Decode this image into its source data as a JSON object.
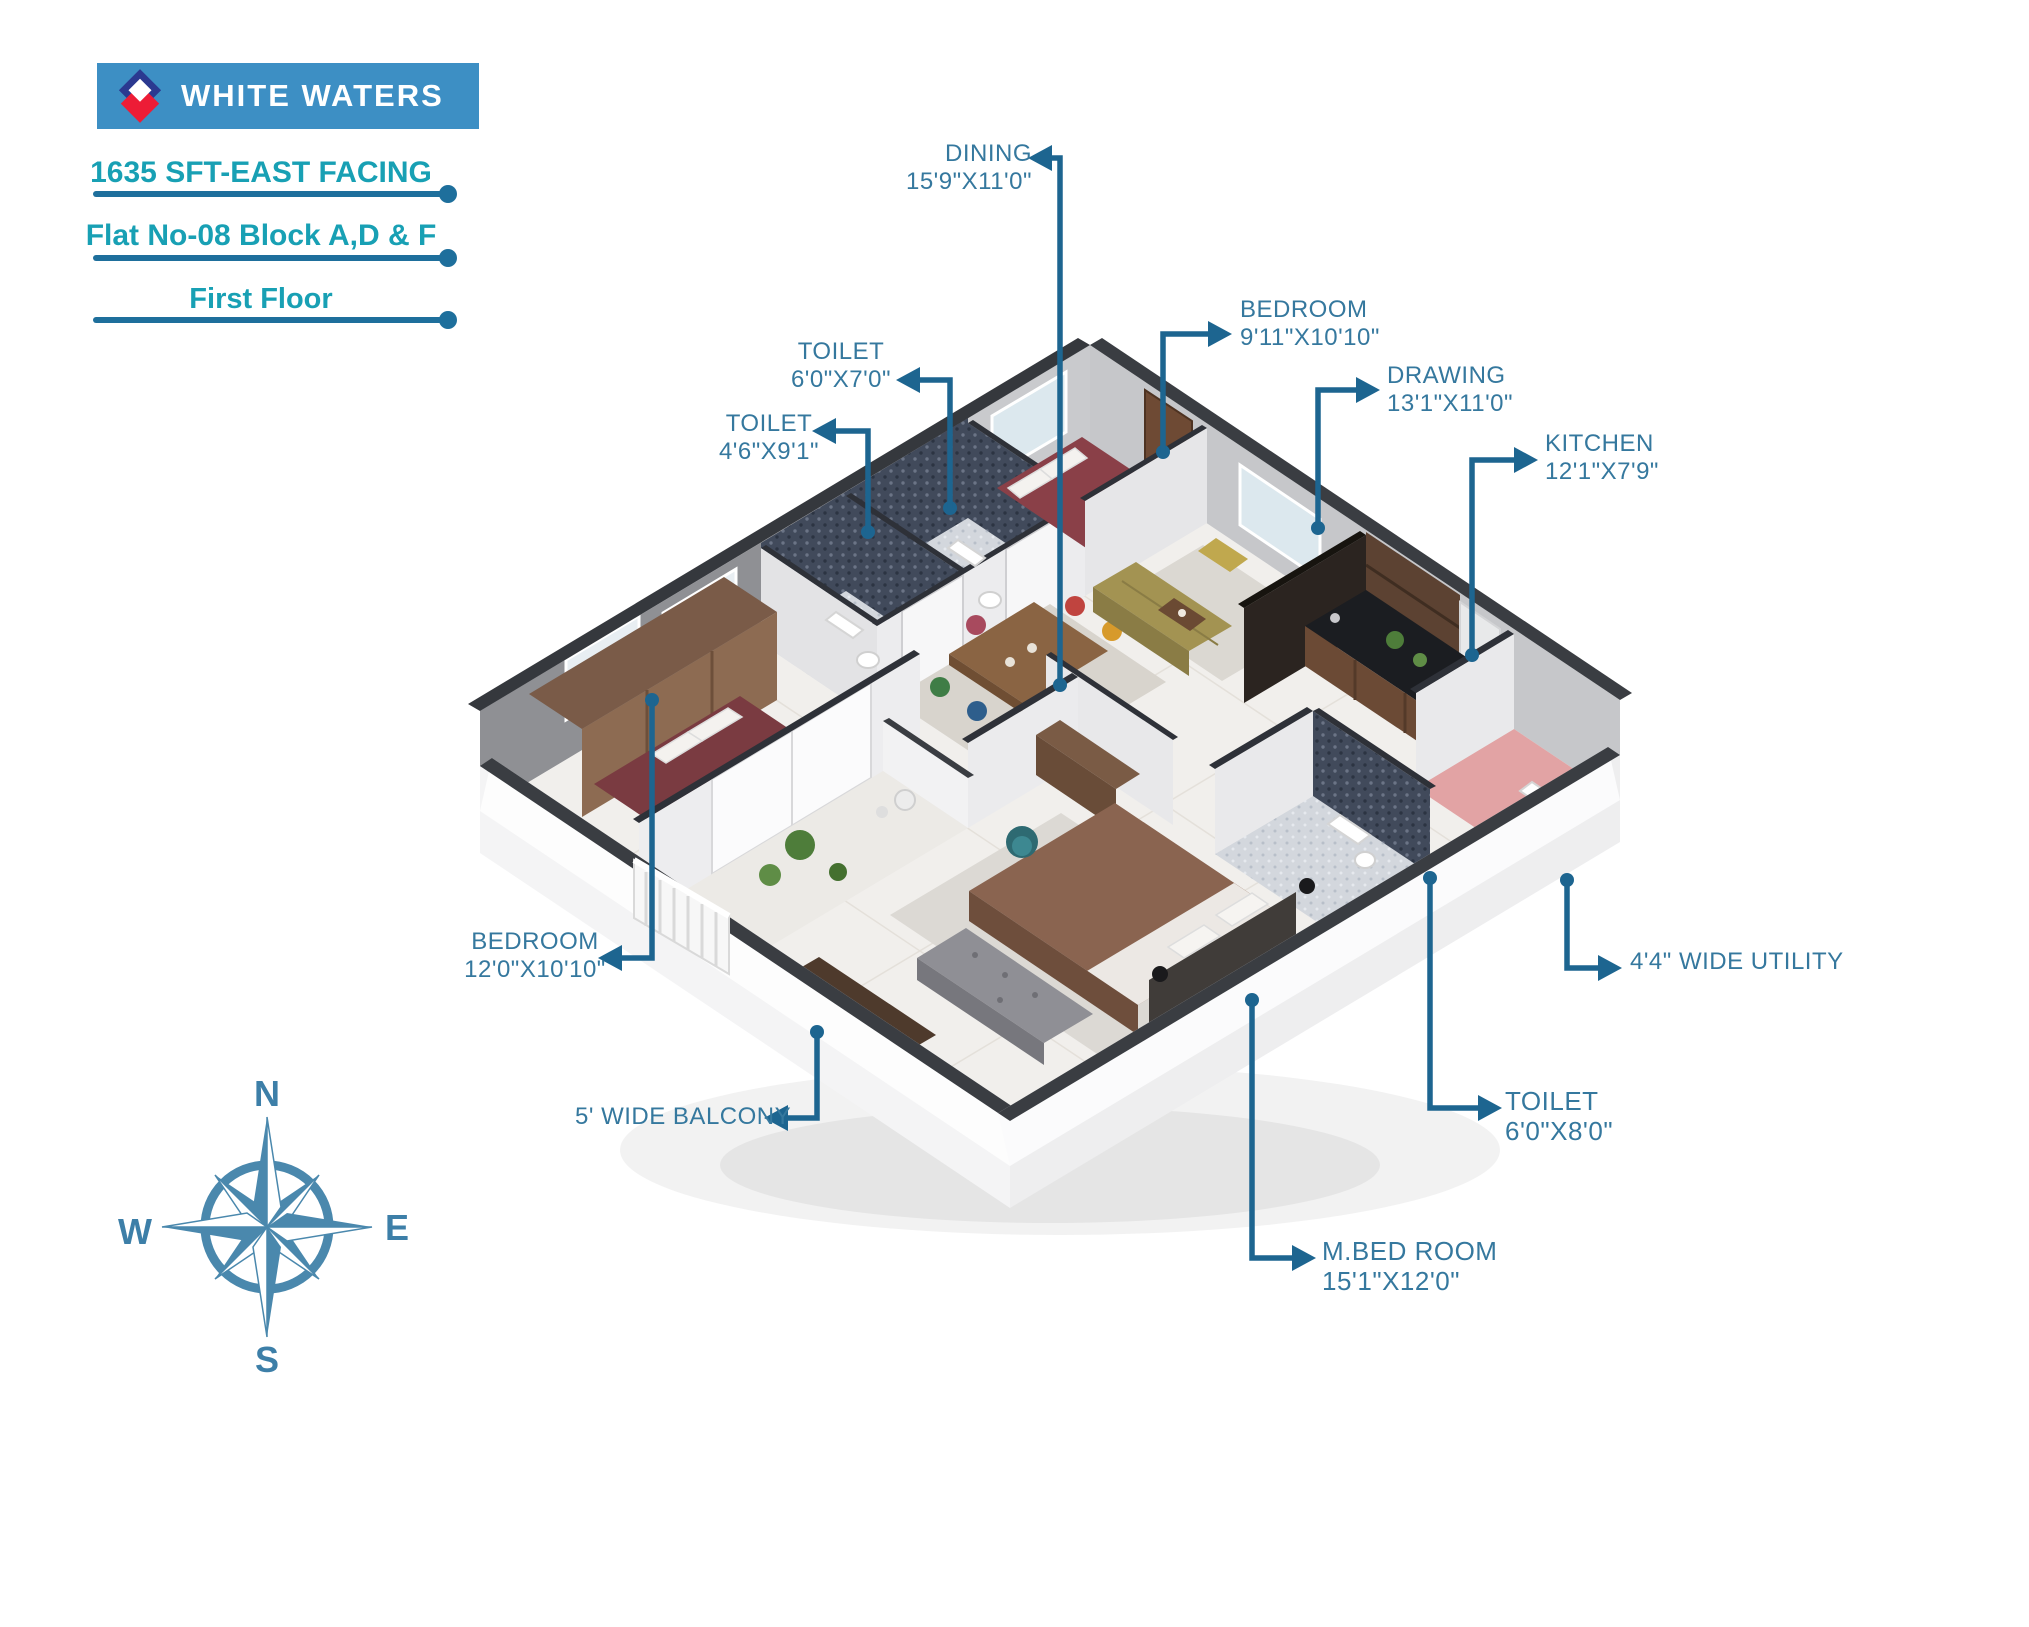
{
  "brand": {
    "title": "WHITE WATERS"
  },
  "header": {
    "line1": "1635 SFT-EAST FACING",
    "line2": "Flat No-08 Block A,D & F",
    "line3": "First Floor"
  },
  "labels": {
    "dining": {
      "name": "DINING",
      "dims": "15'9\"X11'0\""
    },
    "bedroom_top": {
      "name": "BEDROOM",
      "dims": "9'11\"X10'10\""
    },
    "drawing": {
      "name": "DRAWING",
      "dims": "13'1\"X11'0\""
    },
    "kitchen": {
      "name": "KITCHEN",
      "dims": "12'1\"X7'9\""
    },
    "toilet_1": {
      "name": "TOILET",
      "dims": "6'0\"X7'0\""
    },
    "toilet_2": {
      "name": "TOILET",
      "dims": "4'6\"X9'1\""
    },
    "bedroom_left": {
      "name": "BEDROOM",
      "dims": "12'0\"X10'10\""
    },
    "balcony": {
      "name": "5' WIDE BALCONY"
    },
    "utility": {
      "name": "4'4\" WIDE UTILITY"
    },
    "toilet_3": {
      "name": "TOILET",
      "dims": "6'0\"X8'0\""
    },
    "mbed": {
      "name": "M.BED ROOM",
      "dims": "15'1\"X12'0\""
    }
  },
  "compass": {
    "north": "N",
    "east": "E",
    "south": "S",
    "west": "W"
  },
  "colors": {
    "banner_blue": "#3D8FC4",
    "accent_teal": "#18A0B4",
    "rule_blue": "#1E6F9C",
    "label_blue": "#35789E",
    "leader_blue": "#1D6590",
    "logo_navy": "#2B3990",
    "logo_red": "#ED1C36",
    "compass_blue": "#4A88AD"
  }
}
